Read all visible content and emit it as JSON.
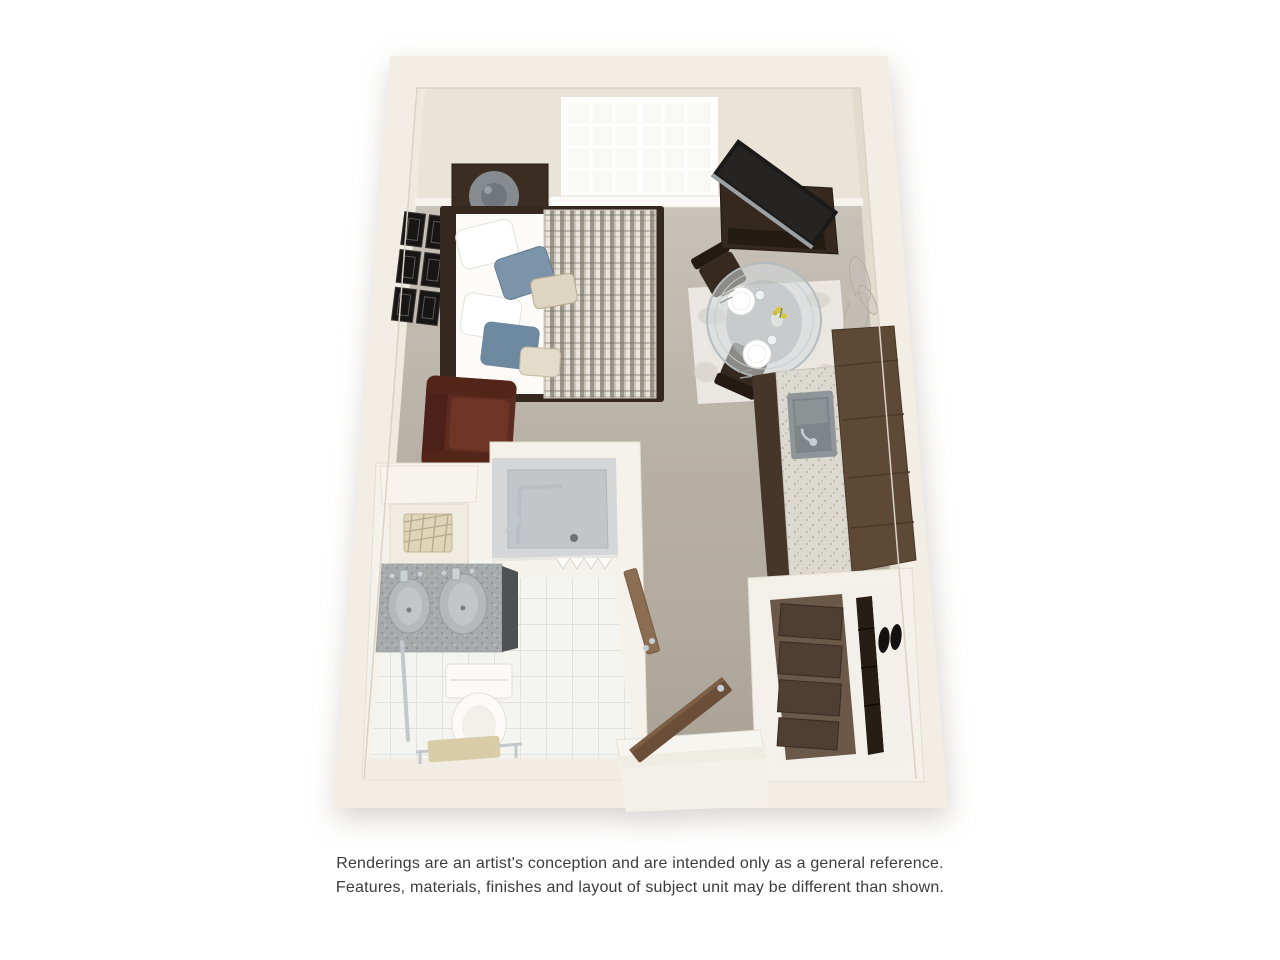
{
  "page": {
    "background": "#ffffff"
  },
  "disclaimer": {
    "line1": "Renderings are an artist's conception and are intended only as a general reference.",
    "line2": "Features, materials, finishes and layout of subject unit may be different than shown."
  },
  "floorplan": {
    "type": "3d-studio-apartment-floor-plan",
    "palette": {
      "wall": "#f2eee5",
      "wall_face": "#e9e3d8",
      "wall_line": "#d9d2c6",
      "carpet": "#b2aa9d",
      "tile": "#f4f4f1",
      "entry_floor": "#f3f0e9",
      "wood_dark": "#35281e",
      "wood_medium": "#5e4836",
      "leather": "#5d2b20",
      "accent_blue": "#7b94a9",
      "linen": "#fcfbf8",
      "rug": "#eae7e2",
      "counter": "#dcd9d0",
      "steel": "#8f9598",
      "chrome": "#c6cbcf",
      "glass": "#d3dadd",
      "door_wood": "#6b4e37",
      "bath_door": "#8b6e52",
      "vanity": "#a7abac",
      "shower_floor": "#c3c6c8",
      "towel": "#d9cda9",
      "basket": "#ded5ba",
      "art_silver": "#b3ada4",
      "dresser": "#6b5848",
      "drawer": "#4f3e31",
      "shoe": "#141210",
      "flower_yellow": "#d9c83f"
    },
    "items": [
      "window",
      "bed",
      "pillows",
      "throw-blanket",
      "nightstand",
      "table-lamp",
      "gallery-frames",
      "armchair",
      "tv-console",
      "television",
      "dining-table",
      "dining-chairs",
      "place-settings",
      "area-rug",
      "wall-art",
      "kitchen-cabinets",
      "kitchen-counter",
      "kitchen-sink",
      "bathroom",
      "walk-in-shower",
      "grab-bars",
      "double-vanity",
      "toilet",
      "storage-niche-basket",
      "towel-rack",
      "bathroom-door",
      "closet",
      "dresser",
      "shoe-shelf",
      "entry-door"
    ]
  }
}
